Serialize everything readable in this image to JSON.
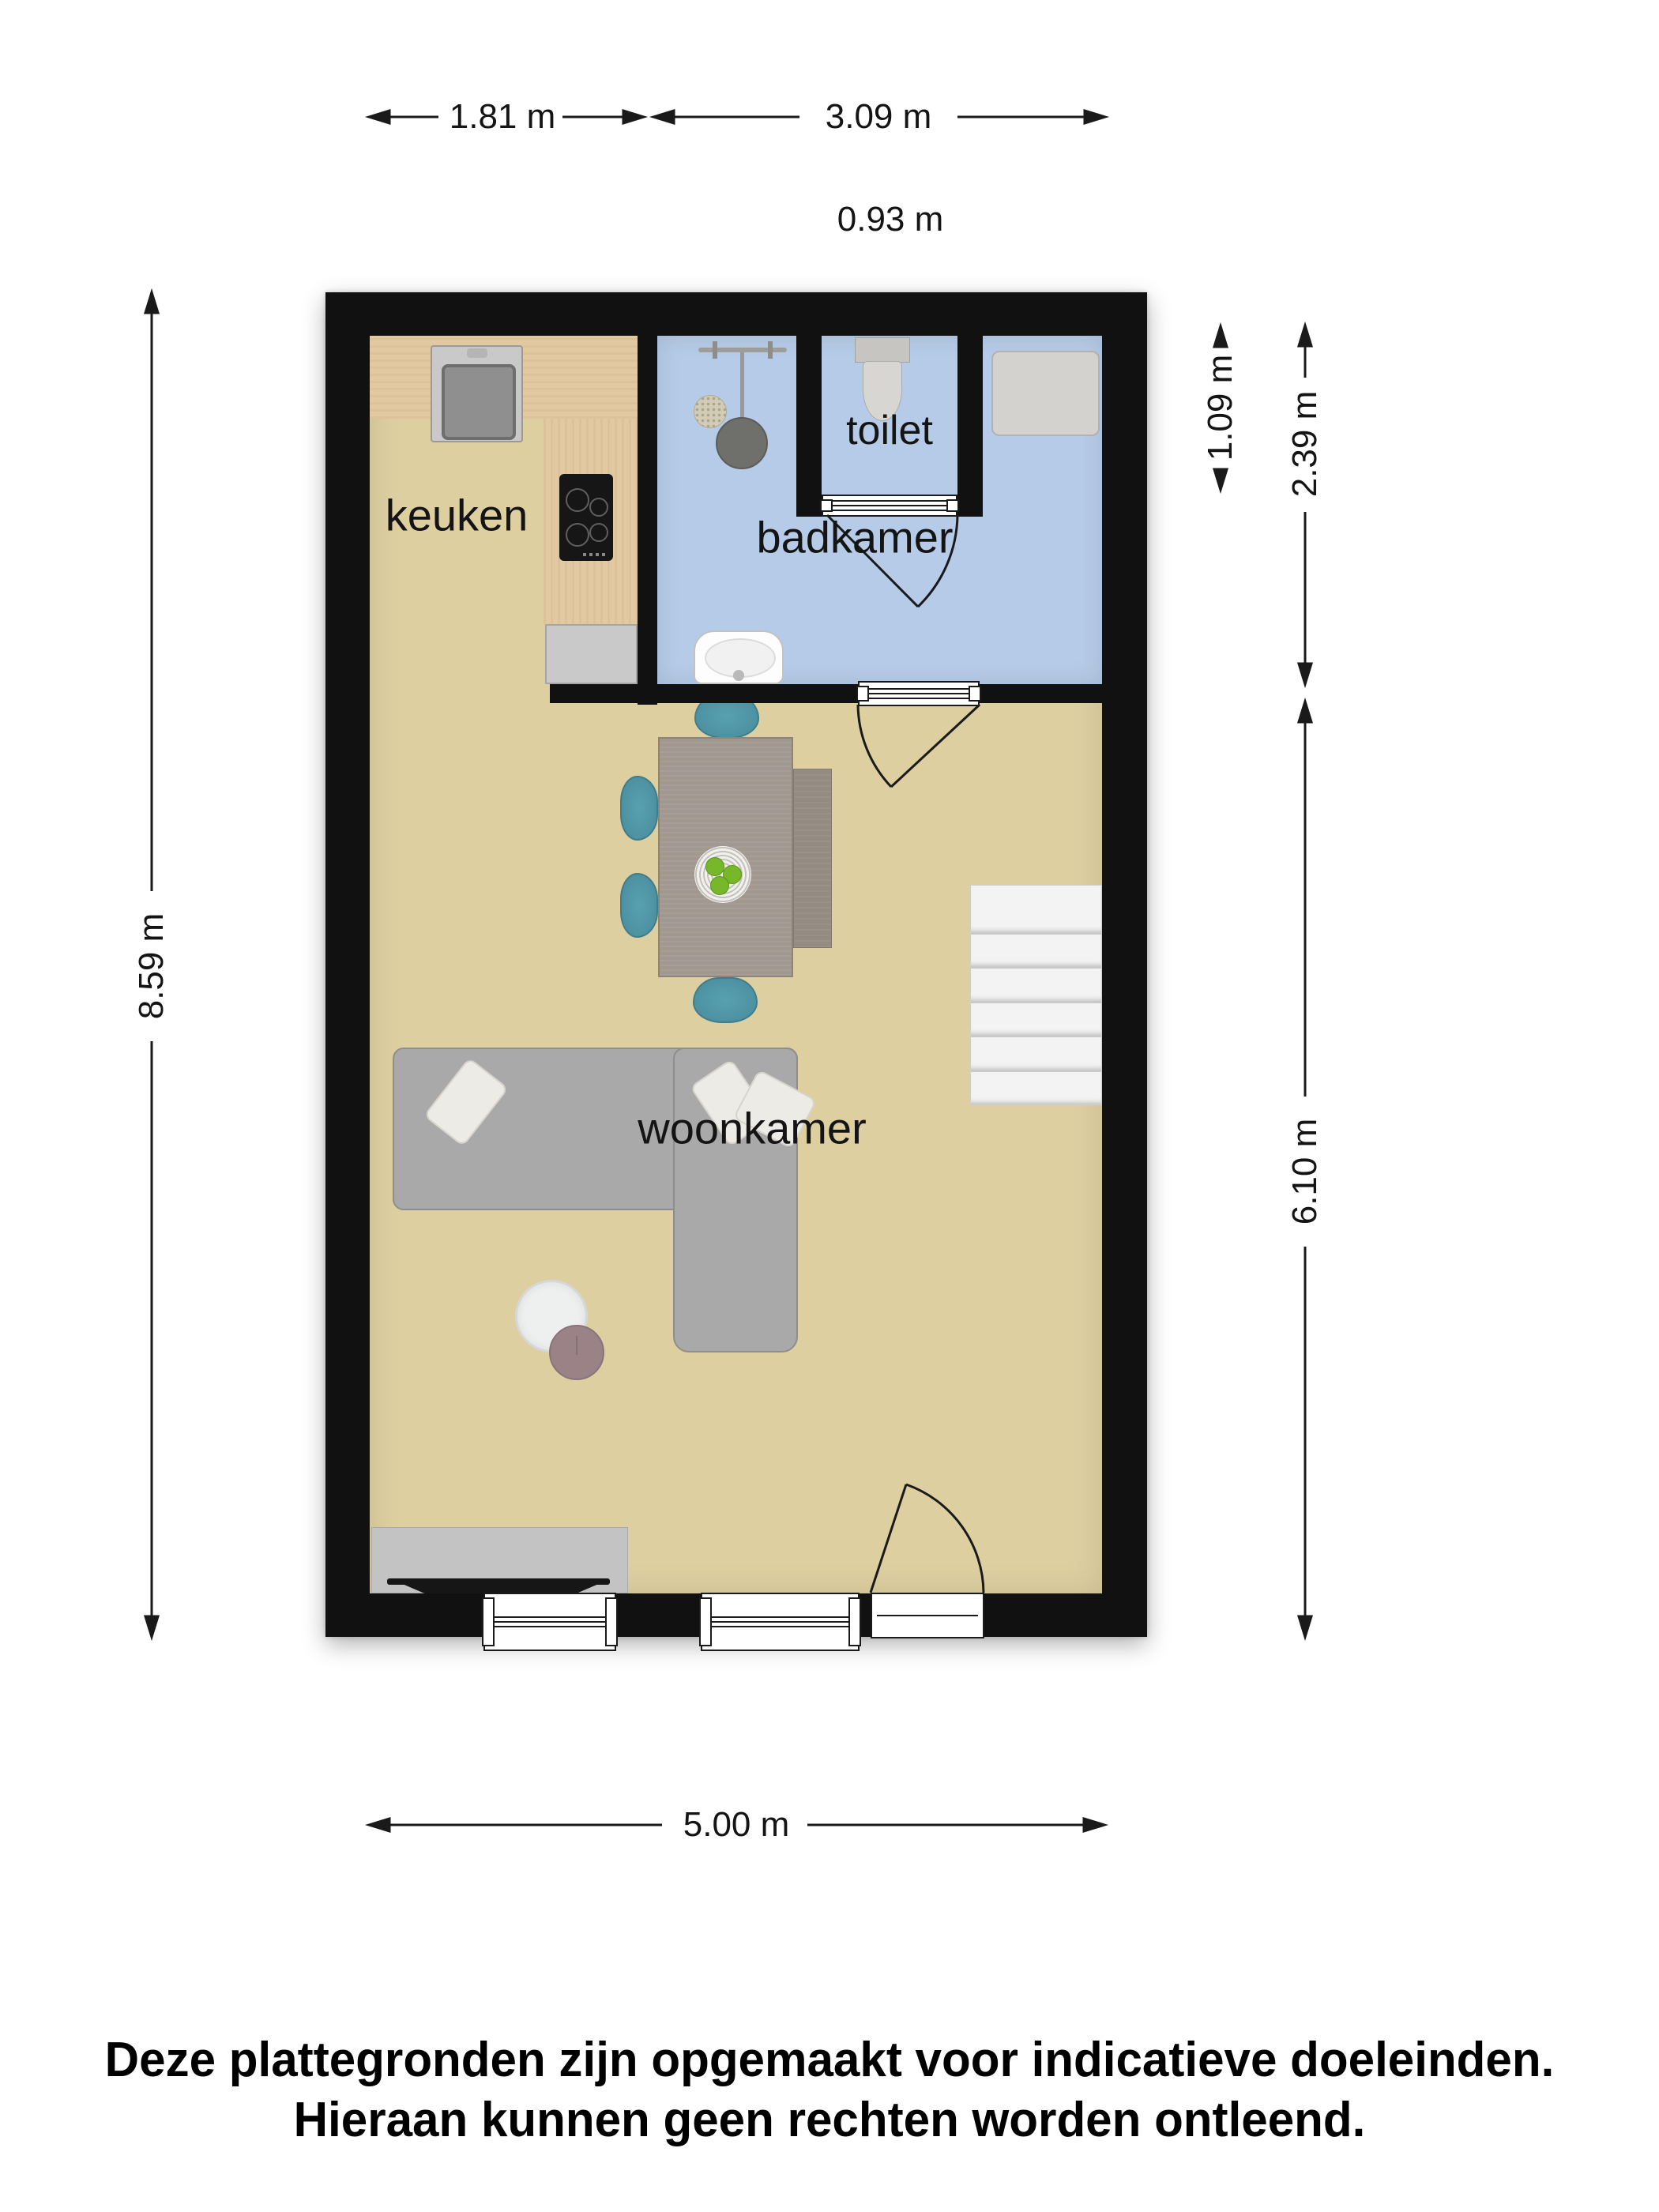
{
  "plan": {
    "rooms": {
      "kitchen": "keuken",
      "bathroom": "badkamer",
      "toilet": "toilet",
      "living": "woonkamer"
    },
    "dimensions": {
      "kitchen_width": "1.81 m",
      "bathroom_width": "3.09 m",
      "toilet_width": "0.93 m",
      "toilet_depth": "1.09 m",
      "bathroom_depth": "2.39 m",
      "living_depth": "6.10 m",
      "total_depth": "8.59 m",
      "total_width": "5.00 m"
    },
    "stairs": {
      "treads": 6
    }
  },
  "disclaimer": {
    "line1": "Deze plattegronden zijn opgemaakt voor indicatieve doeleinden.",
    "line2": "Hieraan kunnen geen rechten worden ontleend."
  },
  "colors": {
    "wall": "#111111",
    "floor": "#ddcfa0",
    "bath": "#b6cbe7",
    "wood": "#e2c9a1",
    "stairs": "#f3f3f3",
    "sofa": "#a9a9a9",
    "chair": "#4d91a1",
    "line": "#1a1a1a"
  }
}
